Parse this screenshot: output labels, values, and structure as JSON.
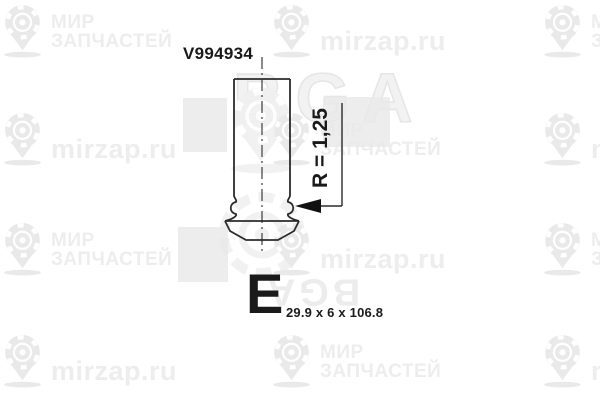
{
  "image": {
    "width": 600,
    "height": 400,
    "background": "#ffffff"
  },
  "drawing": {
    "part_number": "V994934",
    "radius_label": "R = 1,25",
    "size_class_letter": "E",
    "dimensions": "29.9 x 6 x 106.8",
    "line_color": "#2b2b2b",
    "text_color": "#1a1a1a"
  },
  "watermarks": {
    "brand": {
      "name": "BGA"
    },
    "texts": {
      "mir": [
        "МИР",
        "ЗАПЧАСТЕЙ"
      ],
      "ru": [
        "mirzap.ru"
      ]
    },
    "text_color": "#ededed",
    "logo_color": "#e9e9e9",
    "block_color": "#e9e9e9",
    "tiles": [
      {
        "x": 1,
        "y": 4,
        "type": "mir"
      },
      {
        "x": 270,
        "y": 4,
        "type": "ru"
      },
      {
        "x": 541,
        "y": 4,
        "type": "mir"
      },
      {
        "x": 1,
        "y": 112,
        "type": "ru"
      },
      {
        "x": 270,
        "y": 112,
        "type": "mir"
      },
      {
        "x": 541,
        "y": 112,
        "type": "ru"
      },
      {
        "x": 1,
        "y": 222,
        "type": "mir"
      },
      {
        "x": 270,
        "y": 222,
        "type": "ru"
      },
      {
        "x": 541,
        "y": 222,
        "type": "mir"
      },
      {
        "x": 1,
        "y": 334,
        "type": "ru"
      },
      {
        "x": 270,
        "y": 334,
        "type": "mir"
      },
      {
        "x": 541,
        "y": 334,
        "type": "ru"
      }
    ],
    "blocks": [
      {
        "x": 183,
        "y": 98,
        "w": 44,
        "h": 54
      },
      {
        "x": 323,
        "y": 97,
        "w": 67,
        "h": 50
      },
      {
        "x": 178,
        "y": 227,
        "w": 50,
        "h": 55
      }
    ]
  }
}
